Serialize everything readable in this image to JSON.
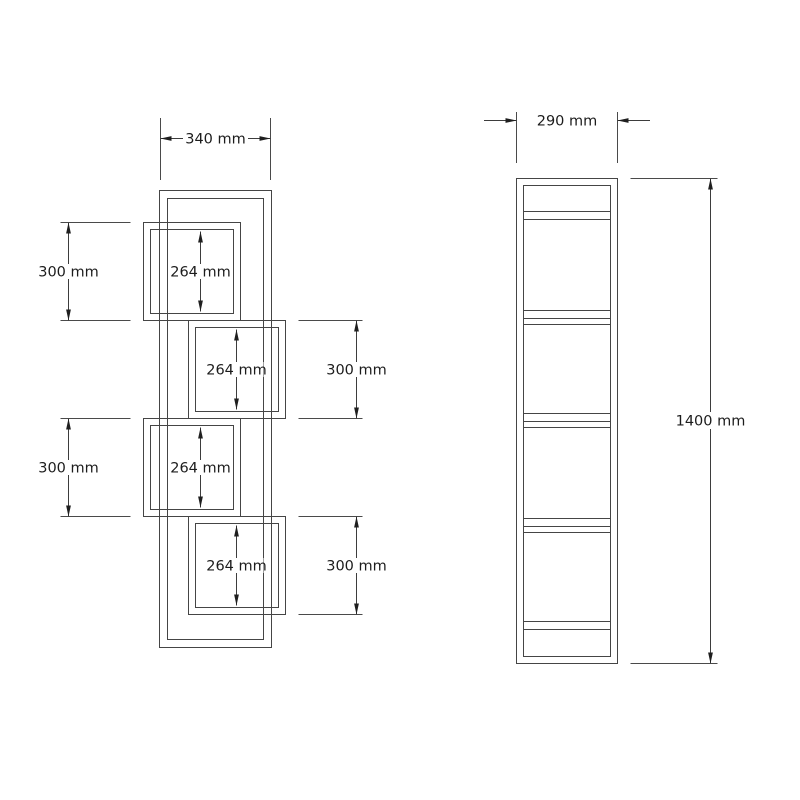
{
  "canvas": {
    "background": "#ffffff",
    "line_color": "#454545",
    "text_color": "#1c1c1c"
  },
  "views": {
    "front": {
      "overall_width": "340 mm",
      "left_sections": [
        "300 mm",
        "300 mm"
      ],
      "right_sections": [
        "300 mm",
        "300 mm"
      ],
      "inner_heights": [
        "264 mm",
        "264 mm",
        "264 mm",
        "264 mm"
      ]
    },
    "side": {
      "overall_depth": "290 mm",
      "overall_height": "1400 mm"
    }
  }
}
